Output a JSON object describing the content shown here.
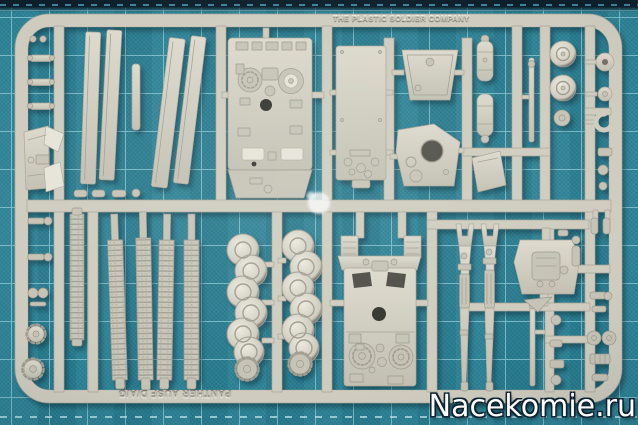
{
  "alt": "Photograph of a light grey plastic model-kit sprue (Panther tank parts) lying on a teal self-healing cutting mat with grid lines",
  "texts": {
    "sprue_brand": "THE PLASTIC SOLDIER COMPANY",
    "sprue_kit": "PANTHER AUSF D/A/G",
    "watermark": "Nacekomie.ru"
  },
  "colors": {
    "mat_base": "#288094",
    "mat_grid": "#a5dce6",
    "mat_edge_dark": "#0c1f2a",
    "plastic": "#cfccbf",
    "plastic_light": "#e6e3d8",
    "plastic_dark": "#a8a598",
    "hole_dark": "#34342e",
    "watermark_fill": "#ffffff",
    "watermark_outline": "#0e2433"
  },
  "mat": {
    "grid_pitch_px": 38
  },
  "parts": [
    "hull-deck-with-glacis",
    "hull-floor-plate",
    "turret-roof",
    "turret-shell",
    "lower-hull-with-engine-deck",
    "track-run-1",
    "track-run-2",
    "track-run-3",
    "track-run-4",
    "road-wheel-strip-1",
    "road-wheel-strip-2",
    "drive-sprocket-1",
    "drive-sprocket-2",
    "gun-barrel-half-1",
    "gun-barrel-half-2",
    "exhaust-muffler-1",
    "exhaust-muffler-2",
    "idler-drum-1",
    "idler-drum-2",
    "fender-strip-1",
    "fender-strip-2",
    "fender-strip-3",
    "fender-strip-4",
    "rear-plate-with-flaps",
    "gearbox-plate",
    "tow-hook",
    "cleaning-rod-top",
    "cleaning-rod-bottom",
    "track-link-ladder",
    "left-sprocket-gear-1",
    "left-sprocket-gear-2",
    "assorted-small-parts",
    "clear-blob"
  ]
}
